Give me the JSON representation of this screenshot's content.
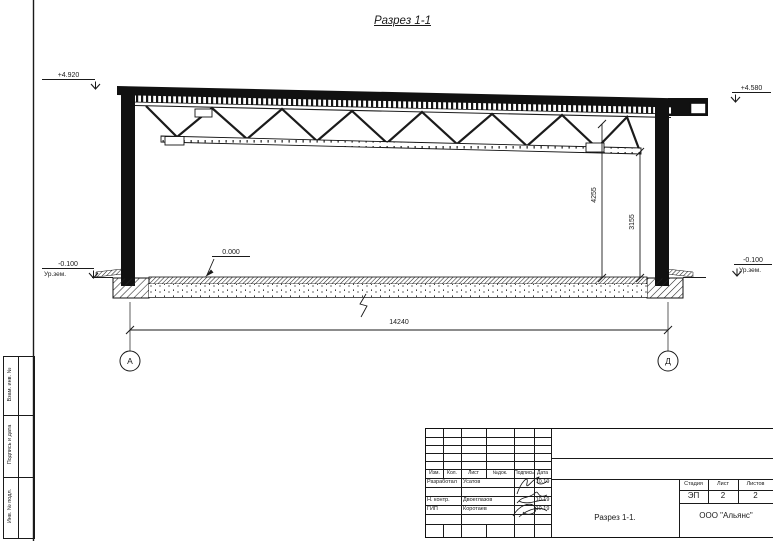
{
  "title": "Разрез 1-1",
  "section": {
    "elev_roof_left": "+4.920",
    "elev_roof_right": "+4.580",
    "elev_floor": "0.000",
    "elev_ground": "-0.100",
    "ground_label": "Ур.зем.",
    "dim_truss_height": "4255",
    "dim_clear_height": "3155",
    "dim_span": "14240",
    "axis_left": "А",
    "axis_right": "Д"
  },
  "side_stamp": {
    "vzam": "Взам. инв. №",
    "podpis_data": "Подпись и дата",
    "inv_podl": "Инв. № подл."
  },
  "title_block": {
    "header": {
      "izm": "Изм.",
      "kol": "Кол.",
      "list": "Лист",
      "ndok": "№док.",
      "podpis": "Подпись",
      "data": "Дата"
    },
    "rows": [
      {
        "role": "Разработал",
        "name": "Усатов",
        "date": "10.19"
      },
      {
        "role": "Н. контр.",
        "name": "Двоеглазов",
        "date": "10.19"
      },
      {
        "role": "ГИП",
        "name": "Коротаев",
        "date": "10.19"
      }
    ],
    "stage_label": "Стадия",
    "sheet_label": "Лист",
    "sheets_label": "Листов",
    "stage": "ЭП",
    "sheet": "2",
    "sheets": "2",
    "doc_title": "Разрез 1-1.",
    "company": "ООО \"Альянс\""
  }
}
